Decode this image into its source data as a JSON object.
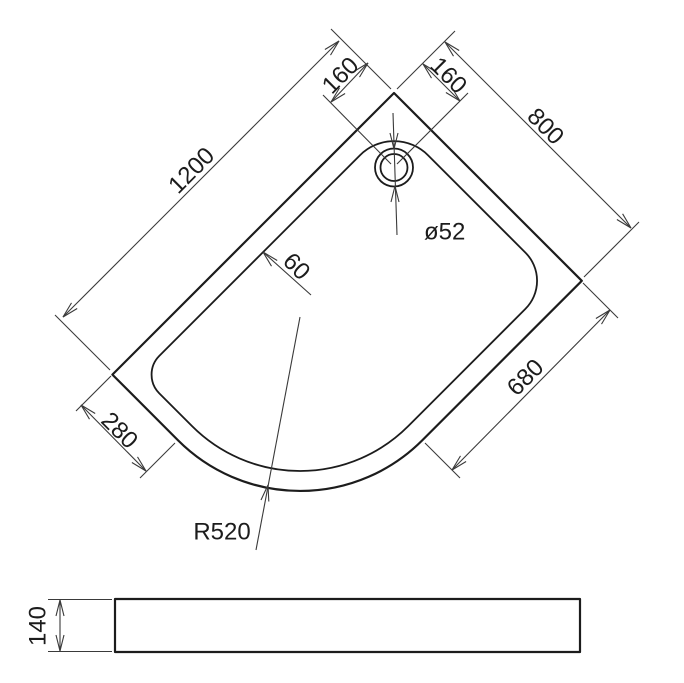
{
  "drawing": {
    "type": "quadrant-shower-tray-technical-drawing",
    "colors": {
      "line": "#1c1c1c",
      "dimension_line": "#3a3a3a",
      "background": "#ffffff"
    },
    "plan": {
      "length": "1200",
      "width": "800",
      "drain_offset_left": "160",
      "drain_offset_right": "160",
      "drain_diameter": "ø52",
      "rim_width": "60",
      "straight_right": "680",
      "straight_left": "280",
      "corner_radius": "R520"
    },
    "profile": {
      "height": "140"
    }
  }
}
